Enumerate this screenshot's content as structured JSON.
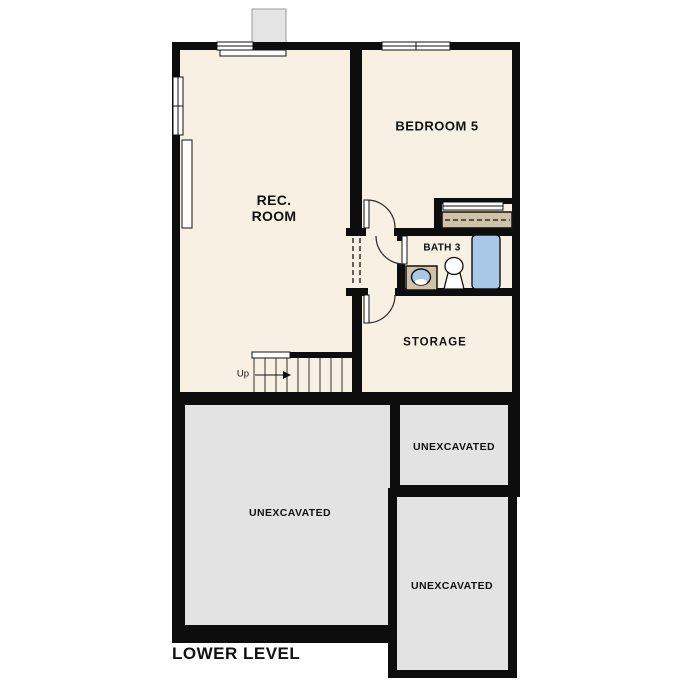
{
  "plan": {
    "title": "LOWER LEVEL",
    "rooms": {
      "rec_room": "REC.\nROOM",
      "bedroom5": "BEDROOM 5",
      "bath3": "BATH 3",
      "storage": "STORAGE"
    },
    "areas": {
      "unexcavated_left": "UNEXCAVATED",
      "unexcavated_top_right": "UNEXCAVATED",
      "unexcavated_bottom_right": "UNEXCAVATED"
    },
    "stairs": {
      "direction_label": "Up"
    },
    "colors": {
      "background": "#ffffff",
      "floor": "#f8f0e3",
      "wall": "#0d0d0d",
      "unexcavated_fill": "#e3e3e3",
      "chimney_fill": "#e4e4e4",
      "casework_tan": "#cfc2a9",
      "fixture_blue": "#a9c7e6"
    }
  }
}
